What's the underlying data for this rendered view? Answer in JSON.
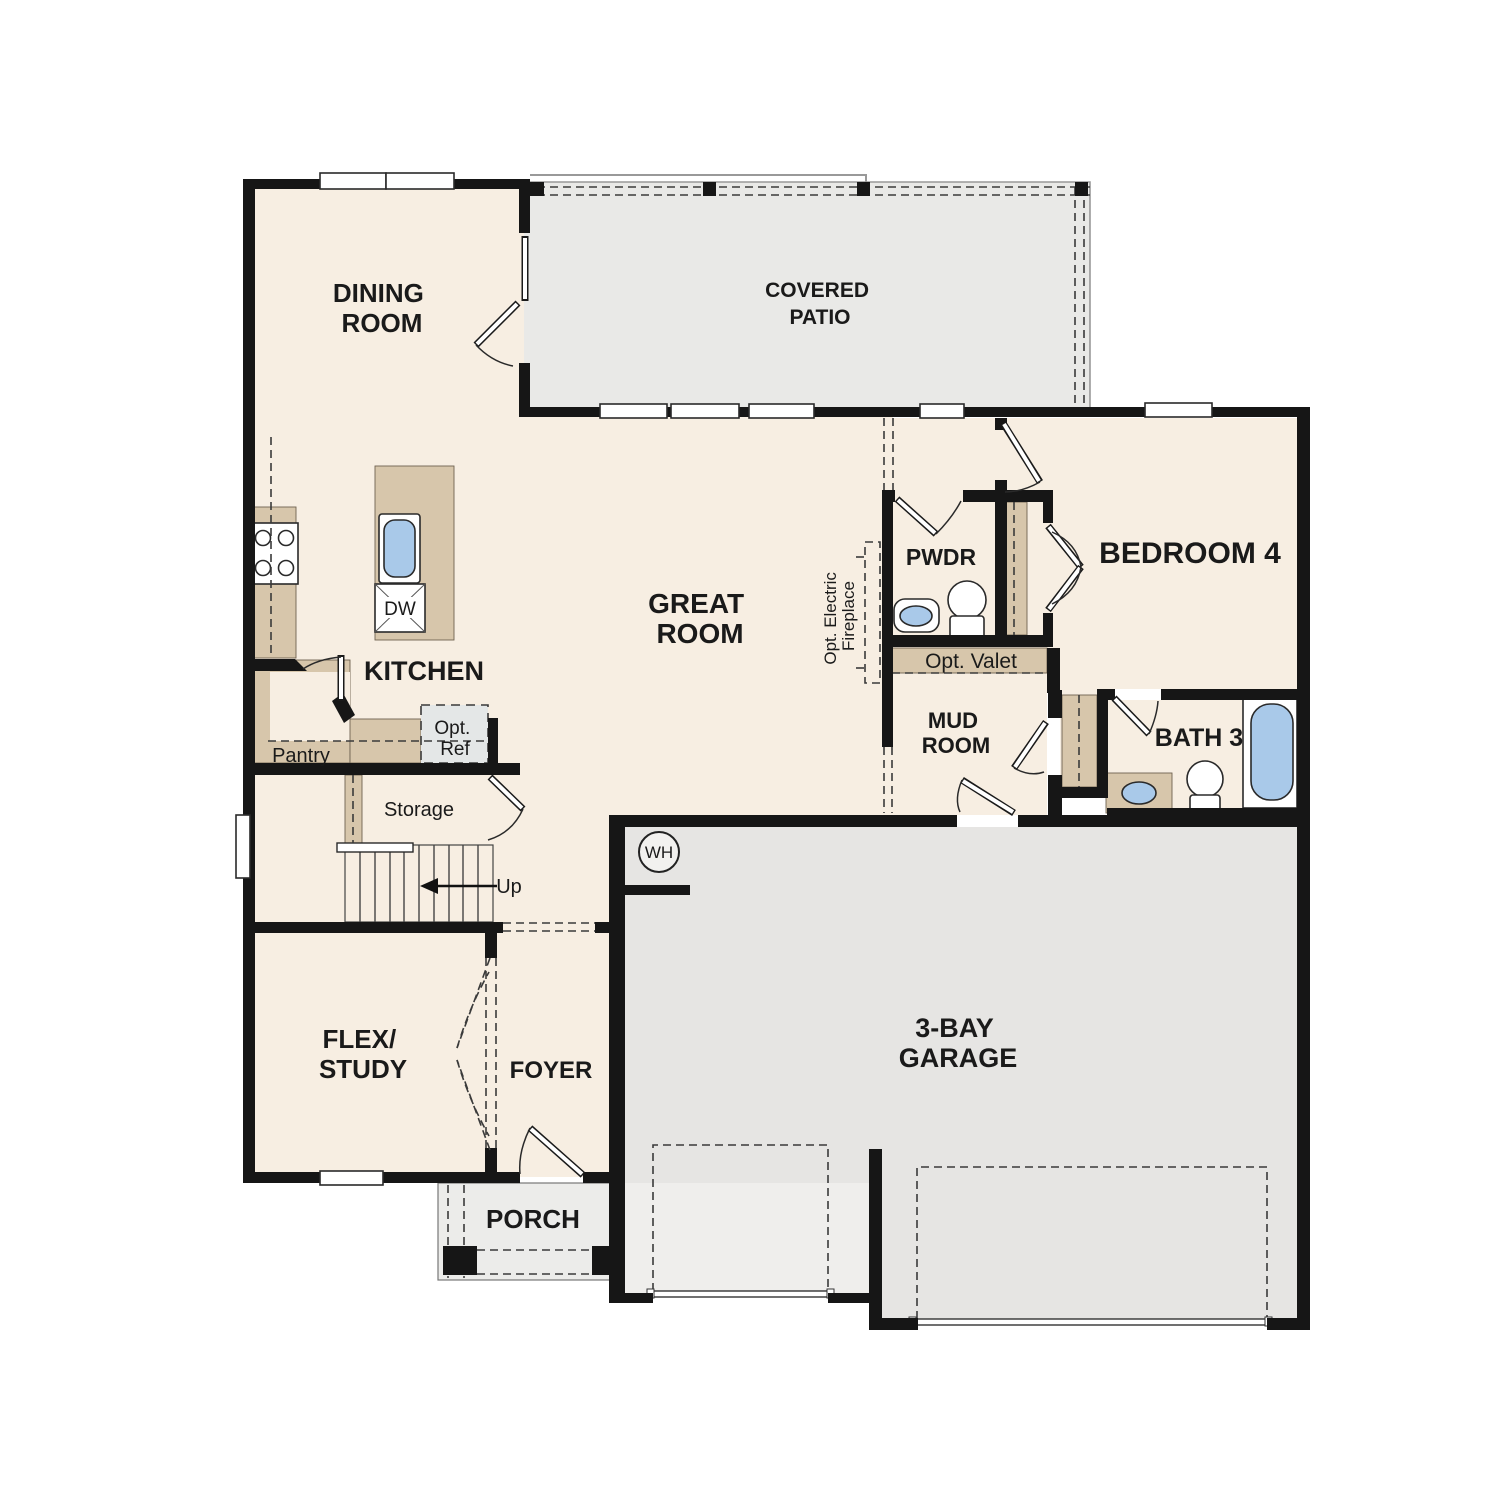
{
  "plan": {
    "type": "single-story floor plan",
    "colors": {
      "interior_floor": "#f7eee2",
      "patio_floor": "#e9e9e7",
      "garage_floor": "#e6e5e3",
      "driveway": "#efeeec",
      "porch_floor": "#ececea",
      "cabinet_tan": "#d7c6ab",
      "fixture_blue": "#a9c9e9",
      "wall_black": "#161616",
      "optional_gray": "#e4e7e7"
    },
    "labels": {
      "dining": {
        "line1": "DINING",
        "line2": "ROOM"
      },
      "covered_patio": {
        "line1": "COVERED",
        "line2": "PATIO"
      },
      "great_room": {
        "line1": "GREAT",
        "line2": "ROOM"
      },
      "kitchen": {
        "text": "KITCHEN"
      },
      "pwdr": {
        "text": "PWDR"
      },
      "bedroom4": {
        "text": "BEDROOM 4"
      },
      "fireplace": {
        "line1": "Opt. Electric",
        "line2": "Fireplace"
      },
      "valet": {
        "text": "Opt. Valet"
      },
      "mud_room": {
        "line1": "MUD",
        "line2": "ROOM"
      },
      "bath3": {
        "text": "BATH 3"
      },
      "pantry": {
        "text": "Pantry"
      },
      "opt_ref": {
        "line1": "Opt.",
        "line2": "Ref"
      },
      "storage": {
        "text": "Storage"
      },
      "up": {
        "text": "Up"
      },
      "wh": {
        "text": "WH"
      },
      "dw": {
        "text": "DW"
      },
      "flex": {
        "line1": "FLEX/",
        "line2": "STUDY"
      },
      "foyer": {
        "text": "FOYER"
      },
      "porch": {
        "text": "PORCH"
      },
      "garage": {
        "line1": "3-BAY",
        "line2": "GARAGE"
      }
    }
  }
}
